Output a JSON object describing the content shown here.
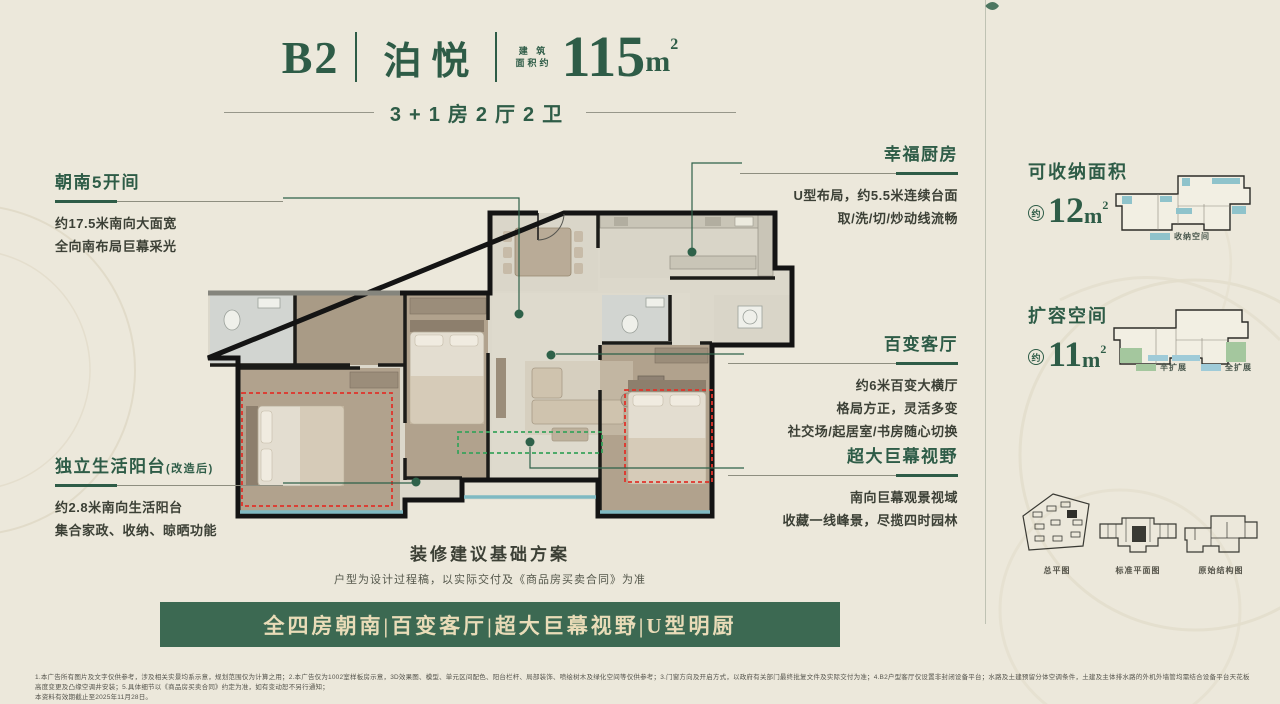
{
  "title": {
    "code": "B2",
    "name": "泊悦",
    "area_label_top": "建 筑",
    "area_label_bottom": "面积约",
    "area_value": "115",
    "area_unit": "m",
    "area_sup": "2",
    "subtitle": "3+1房2厅2卫"
  },
  "callouts": {
    "south": {
      "title": "朝南5开间",
      "lines": [
        "约17.5米南向大面宽",
        "全向南布局巨幕采光"
      ]
    },
    "kitchen": {
      "title": "幸福厨房",
      "lines": [
        "U型布局，约5.5米连续台面",
        "取/洗/切/炒动线流畅"
      ]
    },
    "living": {
      "title": "百变客厅",
      "lines": [
        "约6米百变大横厅",
        "格局方正，灵活多变",
        "社交场/起居室/书房随心切换"
      ]
    },
    "view": {
      "title": "超大巨幕视野",
      "lines": [
        "南向巨幕观景视域",
        "收藏一线峰景，尽揽四时园林"
      ]
    },
    "balcony": {
      "title": "独立生活阳台",
      "suffix": "(改造后)",
      "lines": [
        "约2.8米南向生活阳台",
        "集合家政、收纳、晾晒功能"
      ]
    }
  },
  "note": {
    "title": "装修建议基础方案",
    "subtitle": "户型为设计过程稿，以实际交付及《商品房买卖合同》为准"
  },
  "banner": {
    "text": "全四房朝南|百变客厅|超大巨幕视野|U型明厨"
  },
  "side": {
    "storage": {
      "title": "可收纳面积",
      "approx": "约",
      "value": "12",
      "unit": "m",
      "sup": "2",
      "legend": [
        {
          "label": "收纳空间",
          "color": "#8fc3cb"
        }
      ]
    },
    "expand": {
      "title": "扩容空间",
      "approx": "约",
      "value": "11",
      "unit": "m",
      "sup": "2",
      "legend": [
        {
          "label": "半扩展",
          "color": "#a4c79e"
        },
        {
          "label": "全扩展",
          "color": "#9fcbd8"
        }
      ]
    },
    "diagrams": [
      {
        "label": "总平图"
      },
      {
        "label": "标准平面图"
      },
      {
        "label": "原始结构图"
      }
    ]
  },
  "fine_print": {
    "line1": "1.本广告所有图片及文字仅供参考，涉及相关实景均系示意，规划范围仅为计算之用；2.本广告仅为1002室样板房示意，3D效果图、模型、单元区间配色、阳台栏杆、局部装饰、喷绘树木及绿化空间等仅供参考；3.门窗方向及开启方式，以政府有关部门最终批复文件及实际交付为准；4.B2户型客厅仅设置非封闭设备平台；水路及土建预留分体空调条件，土建及主体排水路的外机外墙管均需结合设备平台天花板高度变更及凸缘空调井安装；5.具体细节以《商品房买卖合同》约定为准，如有变动恕不另行通知；",
    "line2": "本资料有效期截止至2025年11月28日。"
  },
  "colors": {
    "accent_green": "#2e5c47",
    "banner_bg": "#3c6952",
    "banner_text": "#e9dcb8",
    "red_dash": "#e0332a",
    "green_dash": "#3aa35c",
    "storage_teal": "#8fc3cb",
    "expand_green": "#a4c79e",
    "expand_blue": "#9fcbd8",
    "background": "#ece8db"
  }
}
